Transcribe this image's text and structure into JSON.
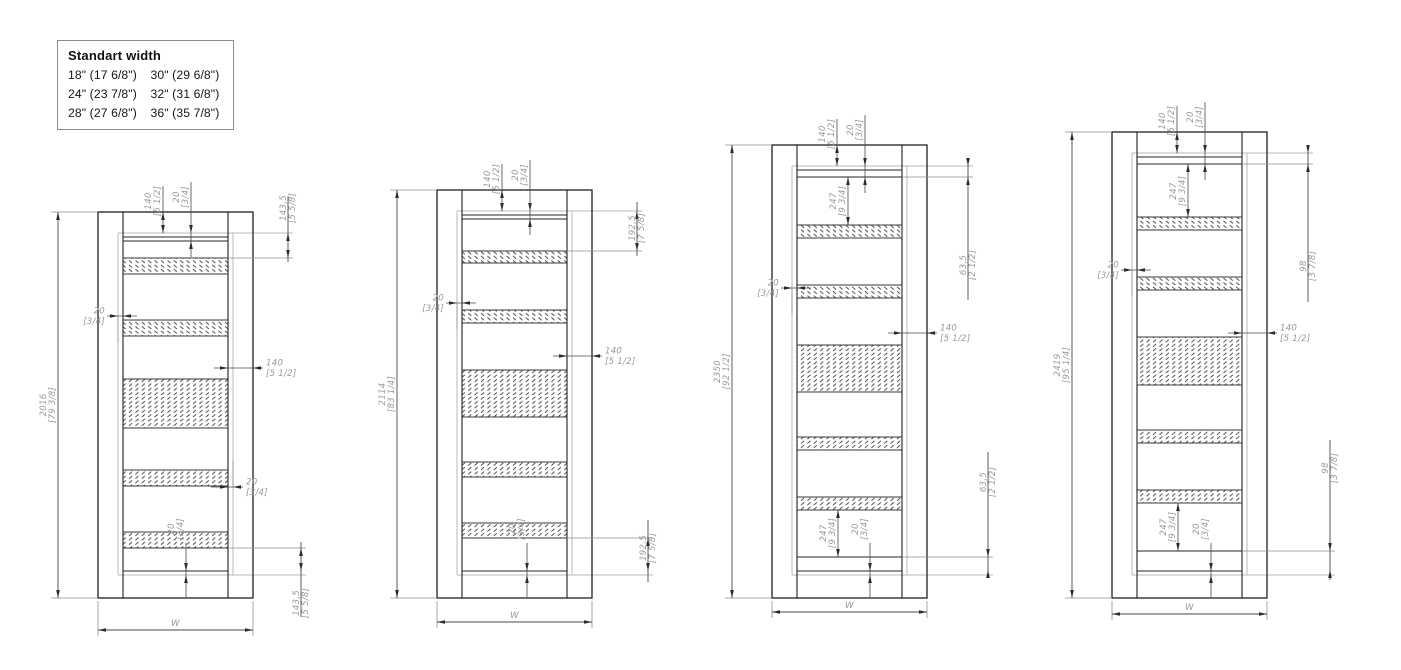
{
  "legend": {
    "title": "Standart width",
    "columns": [
      [
        "18\" (17 6/8\")",
        "24\" (23 7/8\")",
        "28\" (27 6/8\")"
      ],
      [
        "30\" (29 6/8\")",
        "32\" (31 6/8\")",
        "36\" (35 7/8\")"
      ]
    ]
  },
  "width_label": "W",
  "colors": {
    "frame_line": "#1f1f1f",
    "panel_line": "#242424",
    "leaf_line": "#b8b8b8",
    "dim_line": "#4a4a4a",
    "ext_line": "#8f8f8f",
    "arrow": "#2b2b2b",
    "dim_text": "#999999",
    "hatch": "#2d2d2d"
  },
  "doors": [
    {
      "name": "door-2016",
      "x": 98,
      "top": 212,
      "wy": 630,
      "bands": [
        [
          258,
          274
        ],
        [
          320,
          336
        ],
        [
          379,
          428
        ],
        [
          470,
          486
        ],
        [
          532,
          548
        ]
      ],
      "geom": {
        "rail": 241,
        "line2": null,
        "l20y": 316,
        "r140y": 368,
        "r20y": 487,
        "b20x": 186,
        "rt": {
          "x": 288,
          "y1": 233,
          "y2": 258,
          "cy": 208,
          "lt": 196,
          "lb": 262
        },
        "rb": {
          "x": 301,
          "y1": 548,
          "y2": 571,
          "cy": 603,
          "lt": 542,
          "lb": 617
        },
        "t247": null,
        "b247": null
      },
      "dims": {
        "height": [
          "2016",
          "[79 3/8]"
        ],
        "top140": [
          "140",
          "[5 1/2]"
        ],
        "top20": [
          "20",
          "[3/4]"
        ],
        "left20": [
          "20",
          "[3/4]"
        ],
        "right140": [
          "140",
          "[5 1/2]"
        ],
        "right20": [
          "20",
          "[3/4]"
        ],
        "bottom20": [
          "20",
          "[3/4]"
        ],
        "right_top": [
          "143,5",
          "[5 5/8]"
        ],
        "right_bottom": [
          "143,5",
          "[5 5/8]"
        ]
      }
    },
    {
      "name": "door-2114",
      "x": 437,
      "top": 190,
      "wy": 622,
      "bands": [
        [
          251,
          263
        ],
        [
          310,
          323
        ],
        [
          370,
          417
        ],
        [
          462,
          477
        ],
        [
          523,
          538
        ]
      ],
      "geom": {
        "rail": 219,
        "line2": null,
        "l20y": 303,
        "r140y": 356,
        "r20y": null,
        "b20x": 527,
        "rt": {
          "x": 637,
          "y1": 211,
          "y2": 251,
          "cy": 228,
          "lt": 202,
          "lb": 256
        },
        "rb": {
          "x": 648,
          "y1": 538,
          "y2": 571,
          "cy": 548,
          "lt": 520,
          "lb": 582
        },
        "t247": null,
        "b247": null
      },
      "dims": {
        "height": [
          "2114",
          "[83 1/4]"
        ],
        "top140": [
          "140",
          "[5 1/2]"
        ],
        "top20": [
          "20",
          "[3/4]"
        ],
        "left20": [
          "20",
          "[3/4]"
        ],
        "right140": [
          "140",
          "[5 1/2]"
        ],
        "bottom20": [
          "20",
          "[3/4]"
        ],
        "right_top": [
          "192,5",
          "[7 5/8]"
        ],
        "right_bottom": [
          "192,5",
          "[7 5/8]"
        ]
      }
    },
    {
      "name": "door-2350",
      "x": 772,
      "top": 145,
      "wy": 612,
      "bands": [
        [
          225,
          238
        ],
        [
          285,
          298
        ],
        [
          345,
          392
        ],
        [
          437,
          450
        ],
        [
          497,
          510
        ]
      ],
      "geom": {
        "rail": 177,
        "line2": 557,
        "l20y": 288,
        "r140y": 333,
        "r20y": null,
        "b20x": 870,
        "rt": {
          "x": 968,
          "y1": 166,
          "y2": 177,
          "cy": 265,
          "lt": 160,
          "lb": 300
        },
        "rb": {
          "x": 988,
          "y1": 557,
          "y2": 570,
          "cy": 482,
          "lt": 452,
          "lb": 578
        },
        "t247": {
          "x": 848,
          "y1": 177,
          "y2": 225,
          "cy": 201
        },
        "b247": {
          "x": 838,
          "y1": 510,
          "y2": 557,
          "cy": 533
        }
      },
      "dims": {
        "height": [
          "2350",
          "[92 1/2]"
        ],
        "top140": [
          "140",
          "[5 1/2]"
        ],
        "top20": [
          "20",
          "[3/4]"
        ],
        "left20": [
          "20",
          "[3/4]"
        ],
        "right140": [
          "140",
          "[5 1/2]"
        ],
        "bottom20": [
          "20",
          "[3/4]"
        ],
        "top247": [
          "247",
          "[9 3/4]"
        ],
        "bottom247": [
          "247",
          "[9 3/4]"
        ],
        "right_top": [
          "63,5",
          "[2 1/2]"
        ],
        "right_bottom": [
          "63,5",
          "[2 1/2]"
        ]
      }
    },
    {
      "name": "door-2419",
      "x": 1112,
      "top": 132,
      "wy": 614,
      "bands": [
        [
          217,
          230
        ],
        [
          277,
          290
        ],
        [
          337,
          385
        ],
        [
          430,
          443
        ],
        [
          490,
          503
        ]
      ],
      "geom": {
        "rail": 164,
        "line2": 551,
        "l20y": 270,
        "r140y": 333,
        "r20y": null,
        "b20x": 1211,
        "rt": {
          "x": 1308,
          "y1": 153,
          "y2": 164,
          "cy": 266,
          "lt": 147,
          "lb": 302
        },
        "rb": {
          "x": 1330,
          "y1": 551,
          "y2": 570,
          "cy": 468,
          "lt": 440,
          "lb": 580
        },
        "t247": {
          "x": 1188,
          "y1": 164,
          "y2": 217,
          "cy": 191
        },
        "b247": {
          "x": 1178,
          "y1": 503,
          "y2": 551,
          "cy": 527
        }
      },
      "dims": {
        "height": [
          "2419",
          "[95 1/4]"
        ],
        "top140": [
          "140",
          "[5 1/2]"
        ],
        "top20": [
          "20",
          "[3/4]"
        ],
        "left20": [
          "20",
          "[3/4]"
        ],
        "right140": [
          "140",
          "[5 1/2]"
        ],
        "bottom20": [
          "20",
          "[3/4]"
        ],
        "top247": [
          "247",
          "[9 3/4]"
        ],
        "bottom247": [
          "247",
          "[9 3/4]"
        ],
        "right_top": [
          "98",
          "[3 7/8]"
        ],
        "right_bottom": [
          "98",
          "[3 7/8]"
        ]
      }
    }
  ]
}
